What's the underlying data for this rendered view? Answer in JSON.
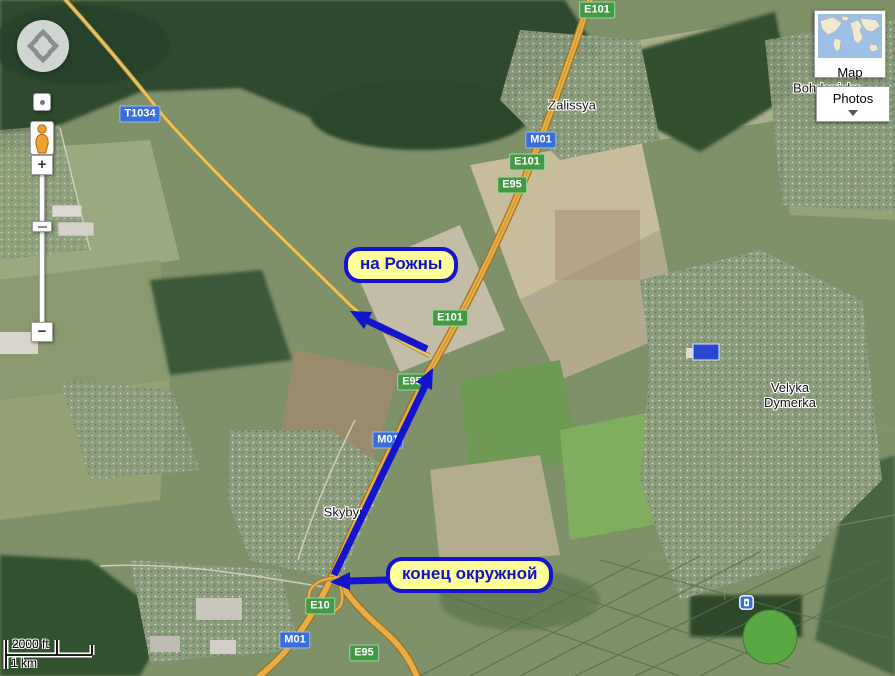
{
  "annotations": {
    "to_rozhny": "на Рожны",
    "ring_road_end": "конец окружной",
    "accent_color": "#1414cc",
    "fill_color": "#ffff99"
  },
  "view_buttons": {
    "map": "Map",
    "photos": "Photos"
  },
  "zoom_controls": {
    "zoom_in": "+",
    "zoom_out": "−"
  },
  "scale": {
    "imperial": "2000 ft",
    "metric": "1 km"
  },
  "road_badges": [
    {
      "label": "E101",
      "type": "green"
    },
    {
      "label": "M01",
      "type": "blue"
    },
    {
      "label": "E101",
      "type": "green"
    },
    {
      "label": "E95",
      "type": "green"
    },
    {
      "label": "T1034",
      "type": "blue"
    },
    {
      "label": "E101",
      "type": "green"
    },
    {
      "label": "E95",
      "type": "green"
    },
    {
      "label": "M01",
      "type": "blue"
    },
    {
      "label": "E10",
      "type": "green"
    },
    {
      "label": "M01",
      "type": "blue"
    },
    {
      "label": "E95",
      "type": "green"
    }
  ],
  "places": {
    "zalissya": "Zalissya",
    "bohdanivka": "Bohdanivka",
    "velyka_line1": "Velyka",
    "velyka_line2": "Dymerka",
    "skybyn": "Skybyn"
  },
  "colors": {
    "badge_green": "#449a44",
    "badge_blue": "#3a6fd9",
    "highway": "#e8ad45"
  }
}
